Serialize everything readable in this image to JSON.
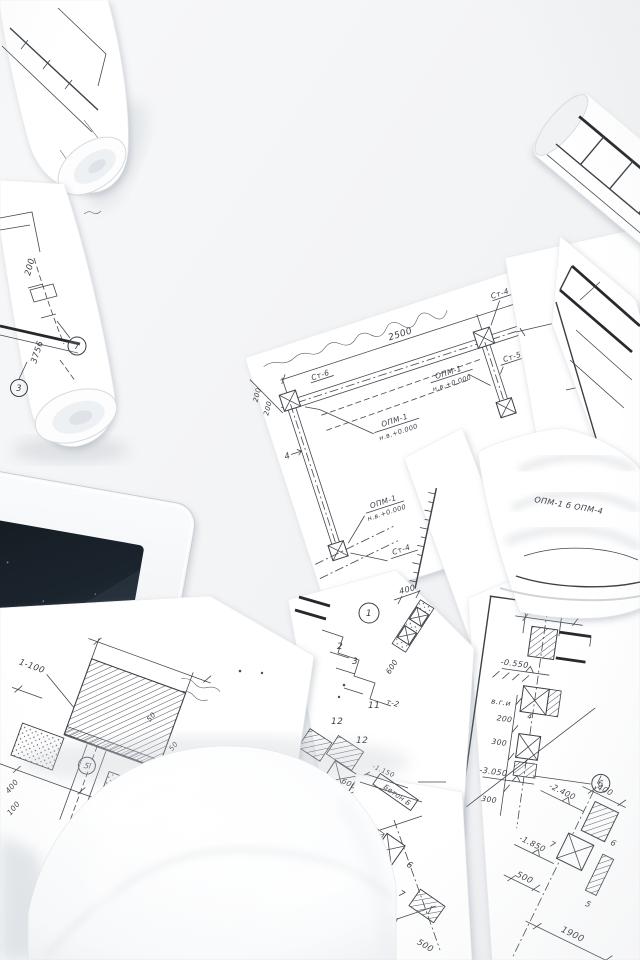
{
  "scene": {
    "background": "#f3f4f6",
    "paper": "#ffffff",
    "ink": "#3a3e45",
    "tablet_screen": "#1b242d"
  },
  "left_roll": {
    "dim_200": "200",
    "bubble_7": "7",
    "dim_3756": "3756",
    "bubble_3": "3"
  },
  "top_right": {
    "mark_st": "Ст",
    "dim_5": "5"
  },
  "central_sheet": {
    "dim_2500": "2500",
    "dim_200a": "200",
    "dim_200b": "200",
    "mark_st6": "Ст-6",
    "mark_st4_top": "Ст-4",
    "mark_st5": "Ст-5",
    "mark_st4_bottom": "Ст-4",
    "bubble_1": "1",
    "axis_4": "4",
    "opm_mid_1": "ОПМ-1",
    "opm_mid_2": "н.в.+0.000",
    "opm_right_1": "ОПМ-1",
    "opm_right_2": "н.в.+0.000",
    "opm_bottom_1": "ОПМ-1",
    "opm_bottom_2": "н.в.+0.000"
  },
  "curl_sheet": {
    "scribble": "ОПМ-1 б ОПМ-4"
  },
  "right_sheet": {
    "dim_200a": "200",
    "dim_200b": "200",
    "elev_0550": "-0.550",
    "mark_vgi": "в.г.и",
    "dim_200c": "200",
    "axis_4": "4",
    "dim_300a": "300",
    "elev_3050": "-3.050",
    "dim_300b": "300",
    "opm_1": "ОПМ-1",
    "opm_2": "н.в.+0.000",
    "bubble_6": "6",
    "dim_400": "400",
    "elev_2400": "-2.400",
    "num_6": "6",
    "num_7": "7",
    "elev_1850": "-1.850",
    "dim_500": "500",
    "dim_1900": "1900",
    "num_5": "5"
  },
  "middle_sheet": {
    "bubble_1": "1",
    "dim_400": "400",
    "num_2": "2",
    "num_3": "3",
    "num_11": "11",
    "num_12a": "12",
    "num_12b": "12",
    "dim_600_rot": "600",
    "mark_t2": "т-2",
    "elev_1150": "-1.150",
    "dim_600": "600",
    "dim_300": "300",
    "mark_t1": "т-1",
    "bubble_6": "6"
  },
  "beton_sheet": {
    "label": "Бетон Б",
    "num_6": "6",
    "num_7": "7",
    "dim_50": "50",
    "dim_500": "500"
  },
  "detail_sheet": {
    "scale_label": "1-100",
    "bubble_5": "5",
    "dim_400": "400",
    "dim_100": "100",
    "dim_50a": "50",
    "dim_50b": "50"
  }
}
